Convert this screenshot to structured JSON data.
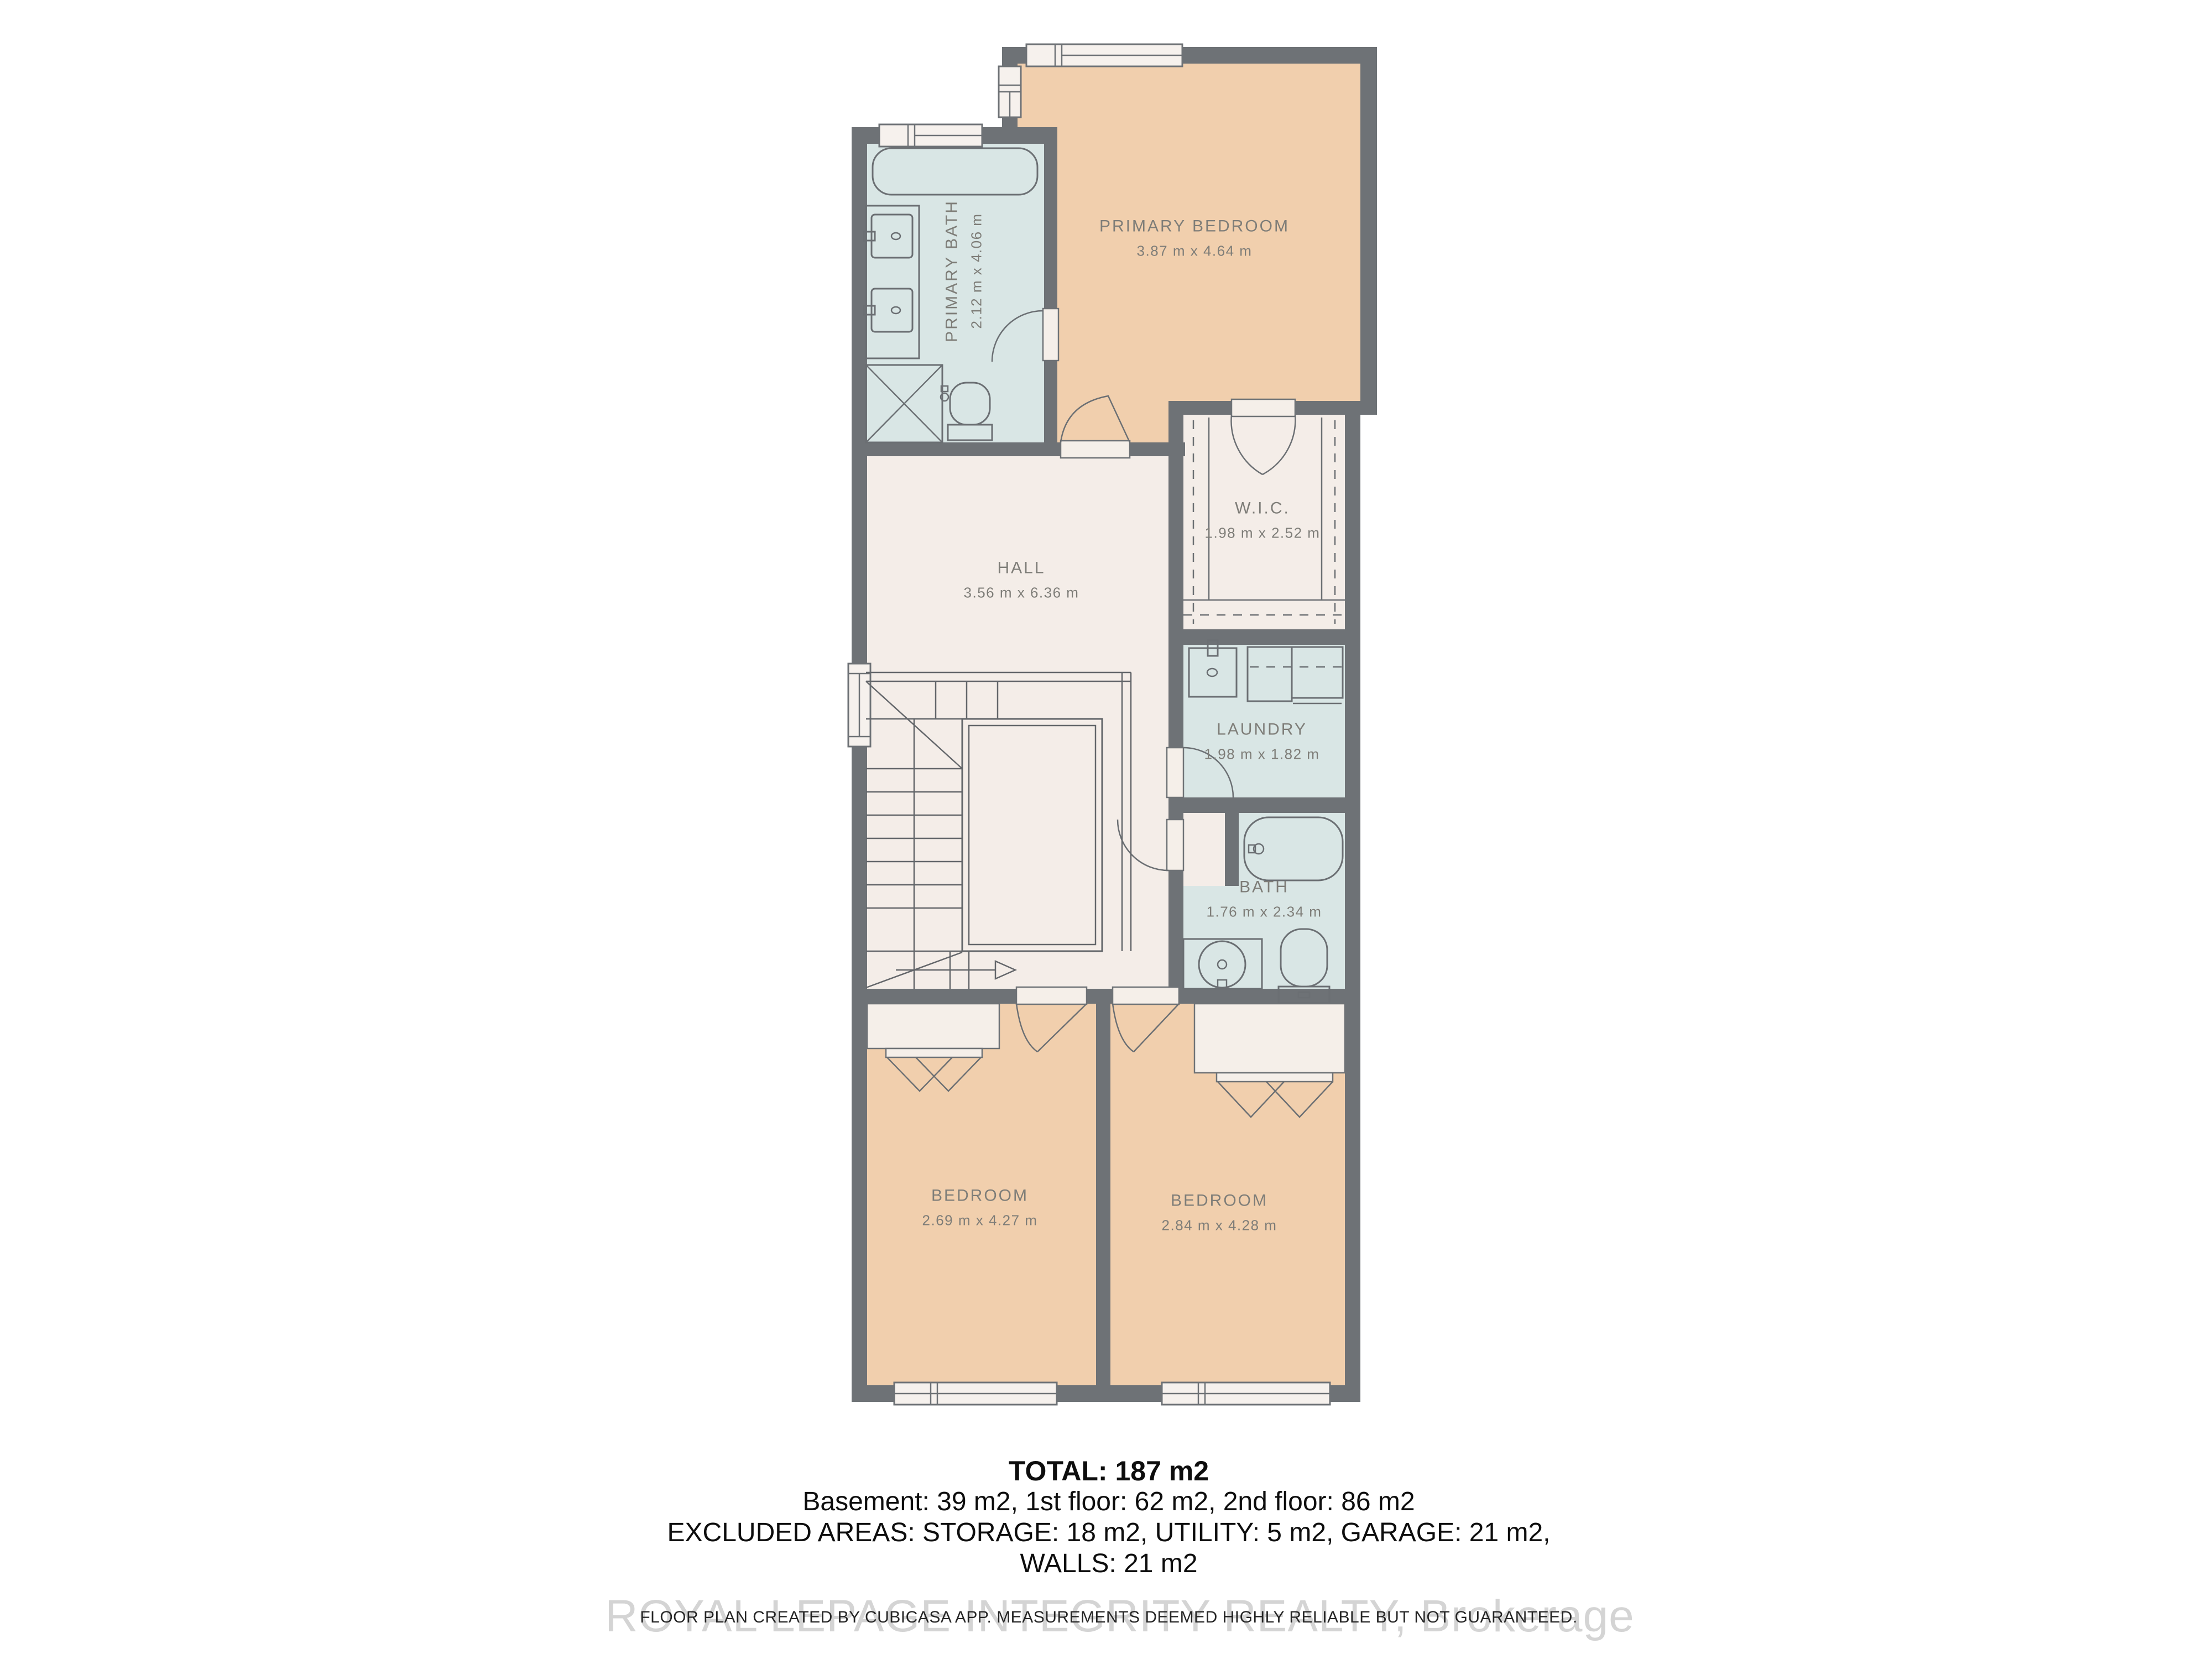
{
  "plan": {
    "rooms": [
      {
        "name": "PRIMARY BEDROOM",
        "dims": "3.87 m x 4.64 m"
      },
      {
        "name": "PRIMARY BATH",
        "dims": "2.12 m x 4.06 m"
      },
      {
        "name": "W.I.C.",
        "dims": "1.98 m x 2.52 m"
      },
      {
        "name": "HALL",
        "dims": "3.56 m x 6.36 m"
      },
      {
        "name": "LAUNDRY",
        "dims": "1.98 m x 1.82 m"
      },
      {
        "name": "BATH",
        "dims": "1.76 m x 2.34 m"
      },
      {
        "name": "BEDROOM",
        "dims": "2.69 m x 4.27 m"
      },
      {
        "name": "BEDROOM",
        "dims": "2.84 m x 4.28 m"
      }
    ],
    "colors": {
      "wall": "#6e7276",
      "bedroom": "#f1cfad",
      "wet": "#d9e6e5",
      "neutral": "#f4ede8",
      "label": "#7e7d78"
    }
  },
  "summary": {
    "total": "TOTAL: 187 m2",
    "floors": "Basement: 39 m2, 1st floor: 62 m2, 2nd floor: 86 m2",
    "excluded": "EXCLUDED AREAS: STORAGE: 18 m2, UTILITY: 5 m2, GARAGE: 21 m2,",
    "walls": "WALLS: 21 m2"
  },
  "watermark": {
    "brokerage": "ROYAL LEPAGE INTEGRITY REALTY, Brokerage",
    "disclaimer": "FLOOR PLAN CREATED BY CUBICASA APP. MEASUREMENTS DEEMED HIGHLY RELIABLE BUT NOT GUARANTEED."
  }
}
